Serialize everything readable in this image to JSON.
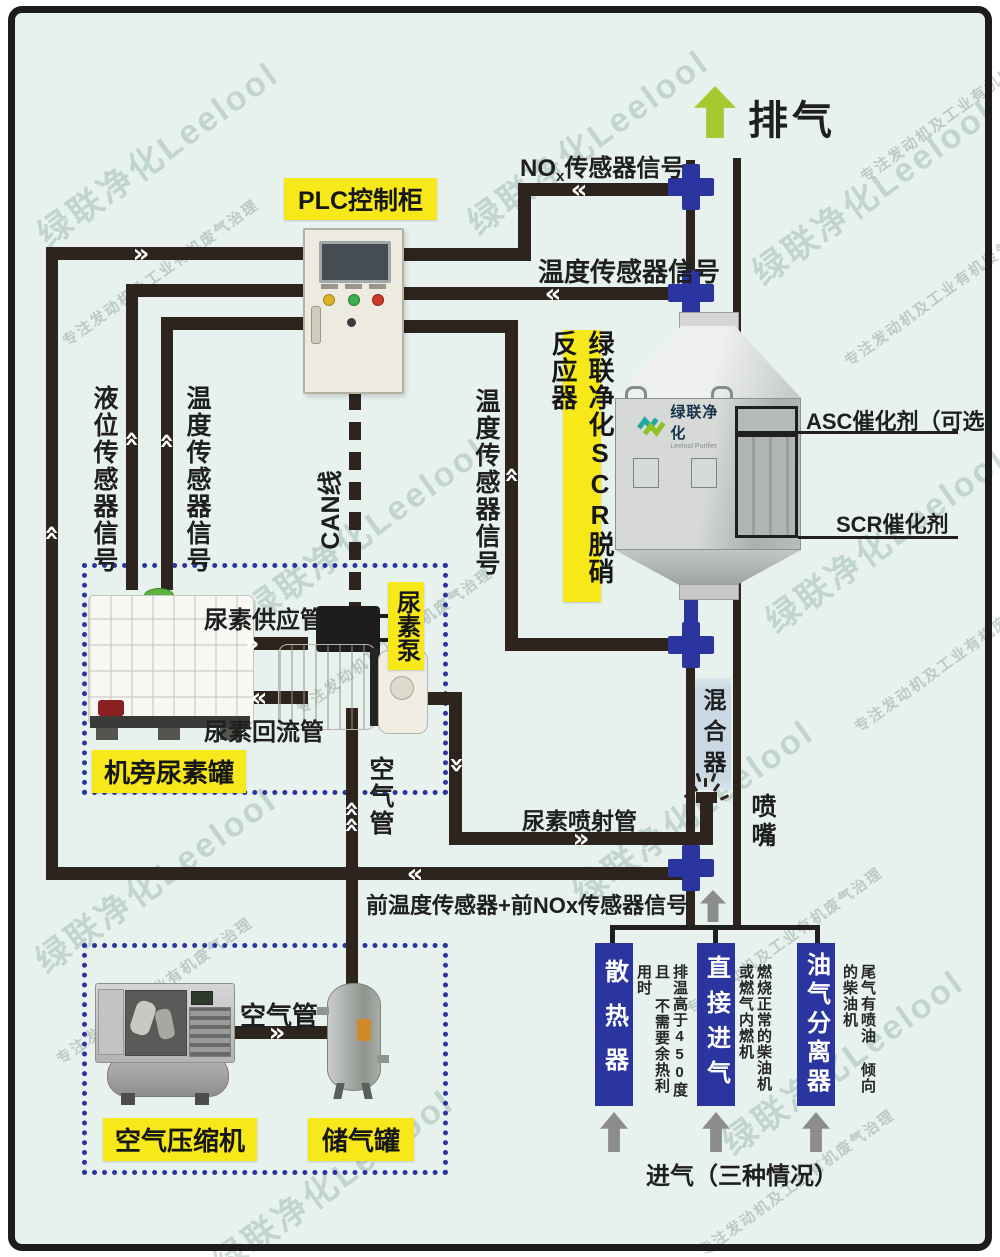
{
  "icons": {
    "chevron_right": "»",
    "chevron_left": "«",
    "up_arrow": "arrow-up",
    "spray": "spray-marks"
  },
  "colors": {
    "bg": "#e7f2ef",
    "pipe": "#2d241e",
    "blue": "#2b35a0",
    "yellow": "#f6e819",
    "green_arrow": "#a5c92f",
    "gray_arrow": "#8c8c8c",
    "mixer_bg": "#c9d8e2"
  },
  "watermark": {
    "big": "绿联净化Leelool",
    "small": "专注发动机及工业有机废气治理"
  },
  "top": {
    "exhaust_label": "排气",
    "nox_prefix": "NO",
    "nox_sub": "x",
    "nox_suffix": "传感器信号",
    "temp_signal": "温度传感器信号"
  },
  "plc": {
    "label": "PLC控制柜"
  },
  "left_signals": {
    "level": "液位传感器信号",
    "temp": "温度传感器信号"
  },
  "mid": {
    "can": "CAN线",
    "temp": "温度传感器信号"
  },
  "reactor": {
    "label": "绿联净化SCR脱硝反应器",
    "logo_cn": "绿联净化",
    "logo_en": "Leelool Purifier",
    "asc": "ASC催化剂（可选）",
    "scr": "SCR催化剂"
  },
  "mixer": {
    "label": "混合器"
  },
  "nozzle": {
    "label": "喷嘴"
  },
  "urea": {
    "supply": "尿素供应管",
    "return": "尿素回流管",
    "pump": "尿素泵",
    "tank": "机旁尿素罐",
    "inject": "尿素喷射管"
  },
  "air": {
    "pipe_vertical": "空气管",
    "pipe_horizontal": "空气管",
    "compressor": "空气压缩机",
    "tank": "储气罐"
  },
  "front": {
    "label": "前温度传感器+前NOx传感器信号"
  },
  "intake": {
    "columns": [
      {
        "label": "散热器",
        "note_lines": [
          "排温高于450度且",
          "不需要余热利用时"
        ]
      },
      {
        "label": "直接进气",
        "note_lines": [
          "燃烧正常的柴油机",
          "或燃气内燃机"
        ]
      },
      {
        "label": "油气分离器",
        "note_lines": [
          "尾气有喷油",
          "倾向的柴油机"
        ]
      }
    ],
    "caption": "进气（三种情况）"
  }
}
